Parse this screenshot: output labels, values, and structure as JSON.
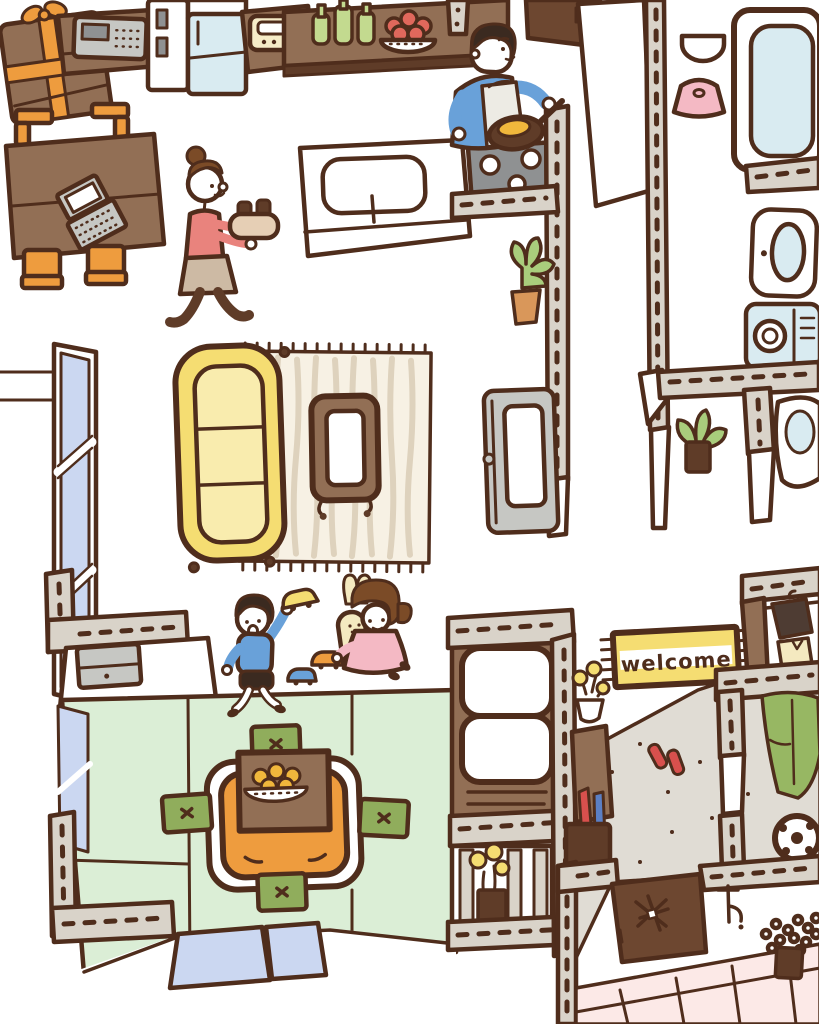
{
  "illustration": {
    "description": "hand-drawn overhead cutaway of a family home",
    "welcome_mat": {
      "text": "welcome"
    },
    "rooms": [
      "study",
      "kitchen",
      "hallway",
      "bathroom",
      "laundry",
      "living-room",
      "kids-play-area",
      "tatami-room",
      "futon-closet",
      "entrance-genkan",
      "garden-path"
    ],
    "people": [
      "woman-carrying-tea-tray",
      "man-cooking-at-stove",
      "boy-raising-toy-car",
      "girl-hugging-bunny-plush"
    ]
  },
  "palette": {
    "outline": "#4f2d1c",
    "white": "#ffffff",
    "wall": "#d9d3c9",
    "wood": "#926f55",
    "wood_dark": "#5f3c28",
    "door_brown": "#6d4730",
    "gray": "#c6c7c3",
    "gray_dark": "#8f9192",
    "orange": "#ee9c3e",
    "yellow": "#f5dd72",
    "yellow_pale": "#f9ecae",
    "cream": "#f6ecc8",
    "rug": "#f7f1e4",
    "rug_stripe": "#ded2bd",
    "tatami": "#dbeed6",
    "cushion_green": "#90ad5c",
    "leaf": "#a9cd7c",
    "bottle": "#c3da8f",
    "light_blue": "#d9ebf1",
    "periwinkle": "#cbd7f1",
    "pink": "#f4b9c4",
    "salmon": "#e9837d",
    "skirt": "#cdbaa4",
    "shirt_blue": "#69a1d9",
    "hair_brown": "#7b4b27",
    "hair_black": "#3b2a20",
    "genkan": "#e0dcd4",
    "tile_pink": "#fce9e7",
    "apron": "#edebe4",
    "red": "#d8504d",
    "apple": "#e0685c",
    "mandarin": "#f0b73c",
    "bunny": "#f4e9c0",
    "jacket": "#97b763",
    "tray": "#e6cfb5",
    "pot": "#d9975a",
    "coat": "#4e3c33",
    "umbrella_blue": "#5b7fc4"
  }
}
